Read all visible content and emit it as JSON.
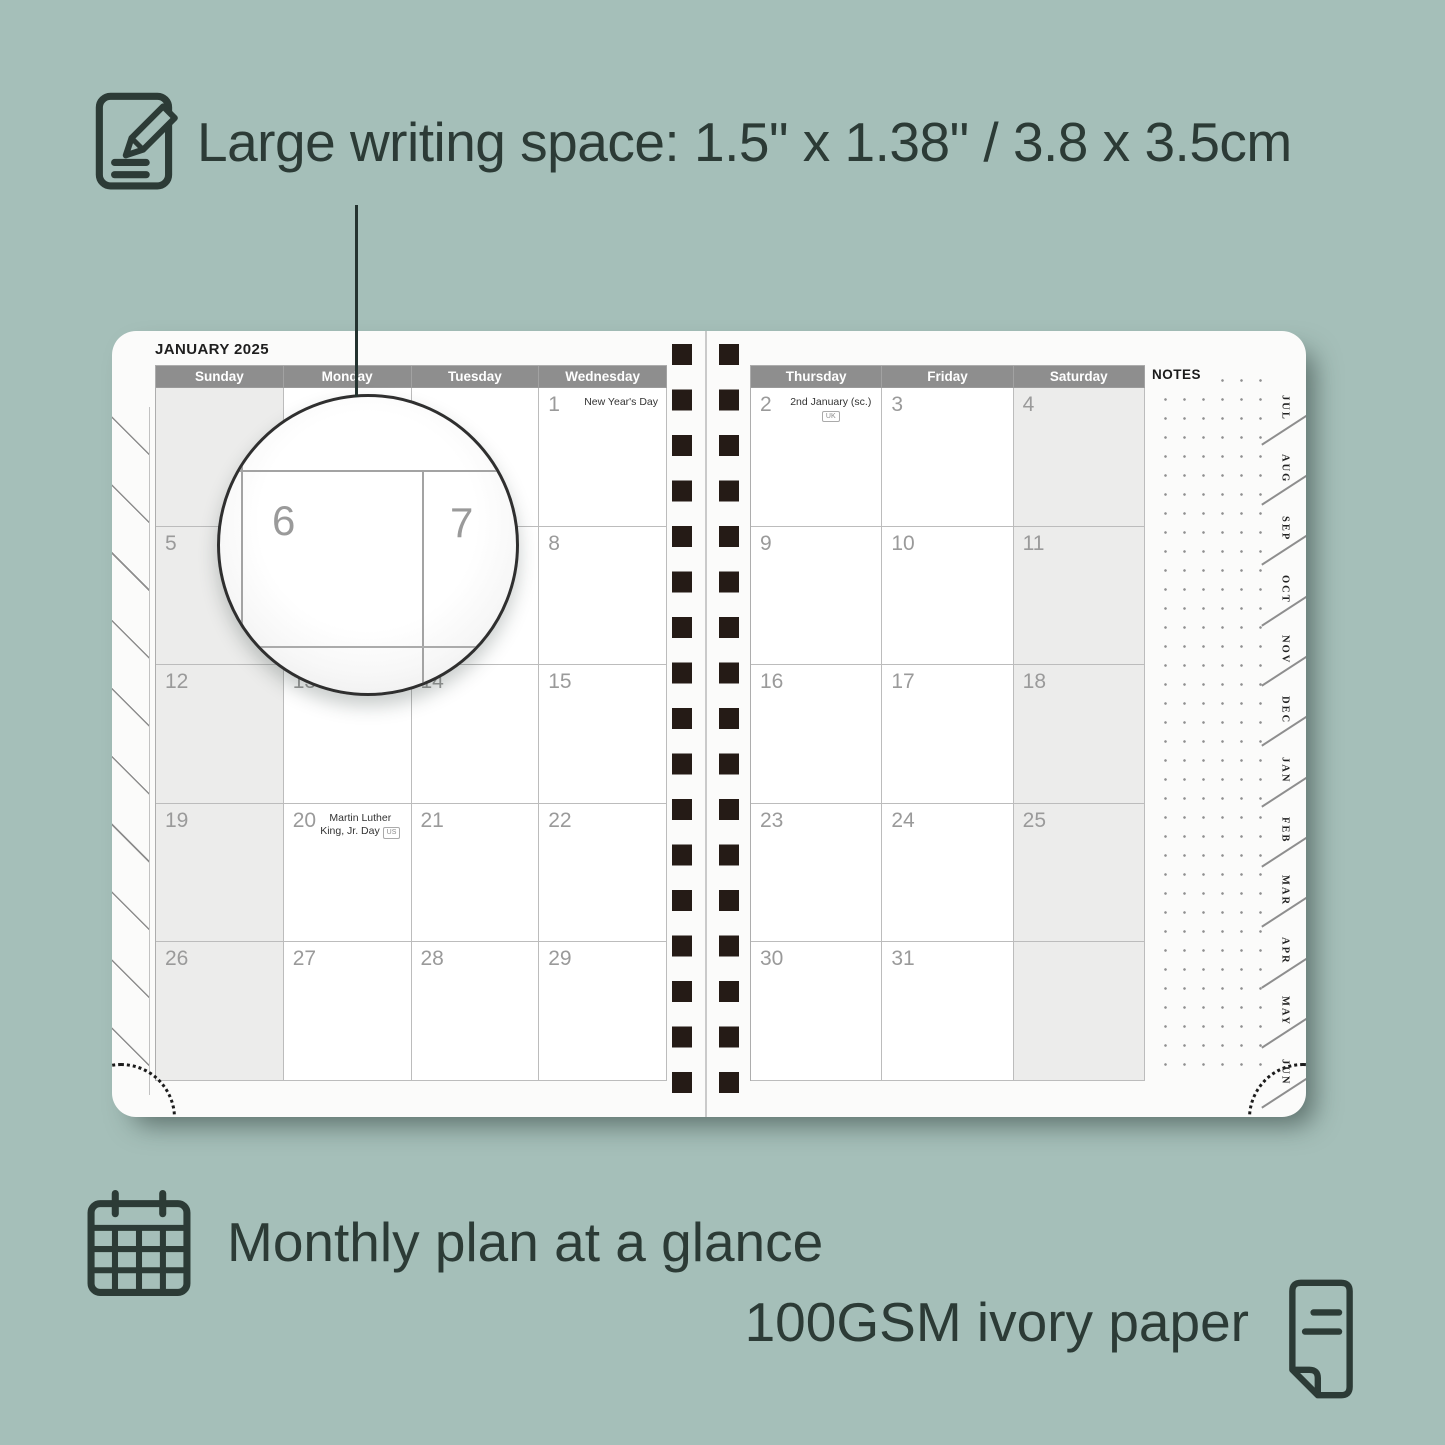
{
  "colors": {
    "background": "#a5bfb9",
    "ink": "#2c3b36",
    "header_gray": "#8e8e8e",
    "shaded_column": "#ececeb",
    "spiral_dark": "#251b16",
    "date_gray": "#9a9a9a"
  },
  "headline": {
    "icon": "pencil-note-icon",
    "text": "Large writing space: 1.5\" x 1.38\" / 3.8 x 3.5cm"
  },
  "planner": {
    "left_page": {
      "title": "JANUARY 2025",
      "day_headers": [
        "Sunday",
        "Monday",
        "Tuesday",
        "Wednesday"
      ],
      "weeks": [
        [
          {
            "day": ""
          },
          {
            "day": ""
          },
          {
            "day": ""
          },
          {
            "day": "1",
            "holiday": "New Year's Day"
          }
        ],
        [
          {
            "day": "5"
          },
          {
            "day": "6"
          },
          {
            "day": "7"
          },
          {
            "day": "8"
          }
        ],
        [
          {
            "day": "12"
          },
          {
            "day": "13"
          },
          {
            "day": "14"
          },
          {
            "day": "15"
          }
        ],
        [
          {
            "day": "19"
          },
          {
            "day": "20",
            "holiday": "Martin Luther King, Jr. Day",
            "badge": "US"
          },
          {
            "day": "21"
          },
          {
            "day": "22"
          }
        ],
        [
          {
            "day": "26"
          },
          {
            "day": "27"
          },
          {
            "day": "28"
          },
          {
            "day": "29"
          }
        ]
      ]
    },
    "right_page": {
      "day_headers": [
        "Thursday",
        "Friday",
        "Saturday"
      ],
      "weeks": [
        [
          {
            "day": "2",
            "holiday": "2nd January (sc.)",
            "badge": "UK"
          },
          {
            "day": "3"
          },
          {
            "day": "4"
          }
        ],
        [
          {
            "day": "9"
          },
          {
            "day": "10"
          },
          {
            "day": "11"
          }
        ],
        [
          {
            "day": "16"
          },
          {
            "day": "17"
          },
          {
            "day": "18"
          }
        ],
        [
          {
            "day": "23"
          },
          {
            "day": "24"
          },
          {
            "day": "25"
          }
        ],
        [
          {
            "day": "30"
          },
          {
            "day": "31"
          },
          {
            "day": ""
          }
        ]
      ],
      "notes_label": "NOTES",
      "month_tabs": [
        "JUL",
        "AUG",
        "SEP",
        "OCT",
        "NOV",
        "DEC",
        "JAN",
        "FEB",
        "MAR",
        "APR",
        "MAY",
        "JUN"
      ]
    },
    "magnifier": {
      "left_number": "6",
      "right_number": "7"
    }
  },
  "features": {
    "monthly": {
      "icon": "calendar-grid-icon",
      "text": "Monthly plan at a glance"
    },
    "paper": {
      "icon": "paper-sheet-icon",
      "text": "100GSM ivory paper"
    }
  }
}
